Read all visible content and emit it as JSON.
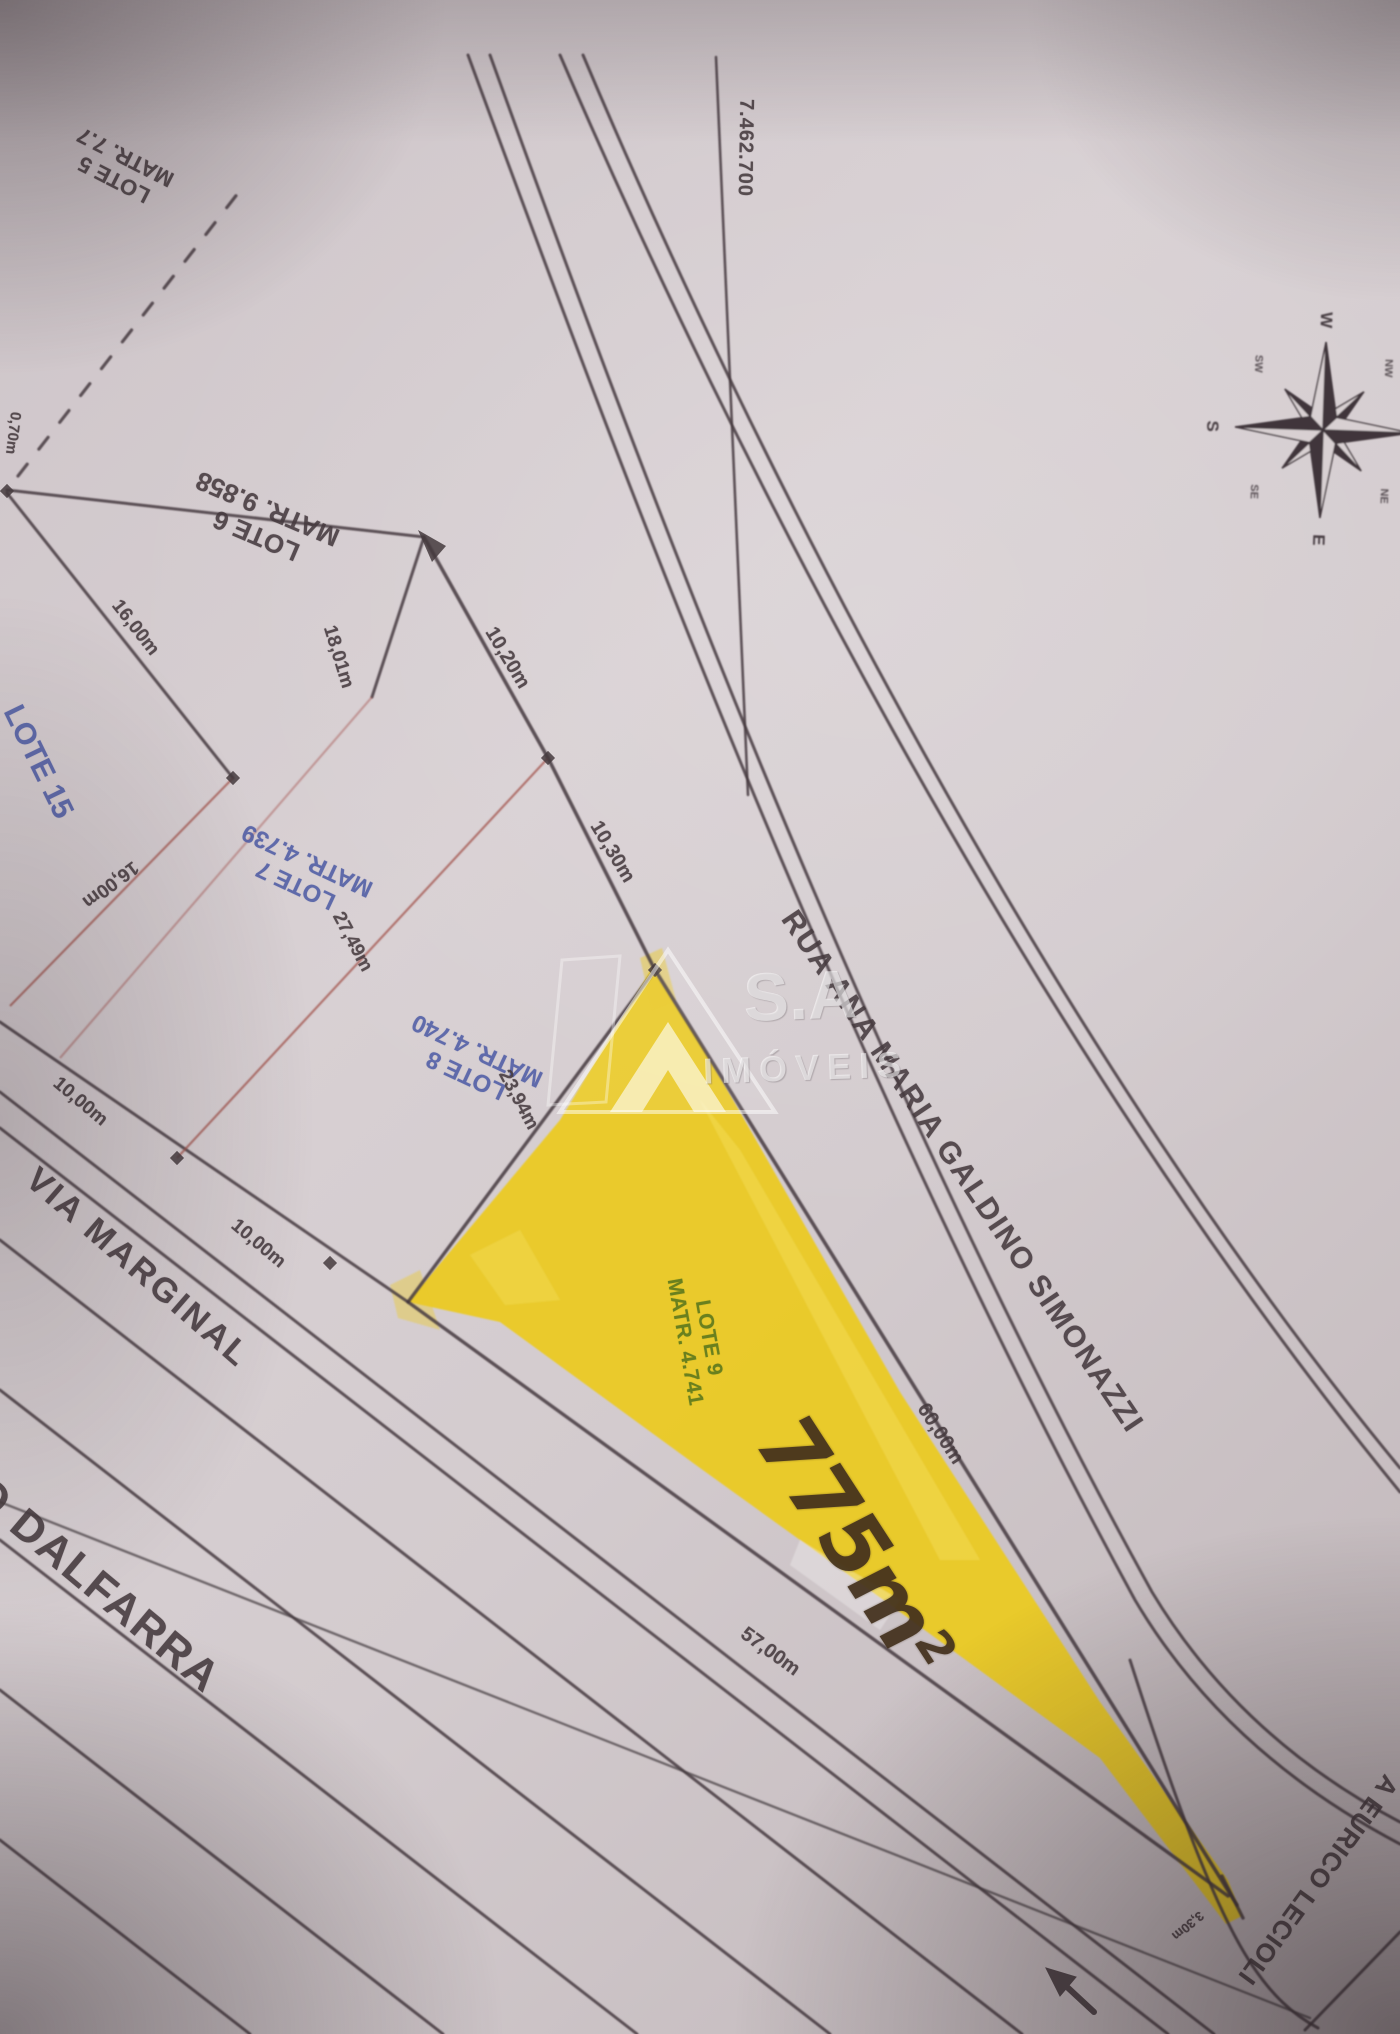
{
  "paper": {
    "coordinate_label": "7.462.700",
    "compass": {
      "n": "N",
      "e": "E",
      "s": "S",
      "w": "W",
      "ne": "NE",
      "nw": "NW",
      "se": "SE",
      "sw": "SW"
    },
    "watermark": {
      "brand": "S.A",
      "word": "IMÓVEIS"
    },
    "streets": {
      "rua_ana": "RUA ANA MARIA GALDINO SIMONAZZI",
      "via_marginal": "VIA MARGINAL",
      "dalfarra": "O DALFARRA",
      "eurico": "A EURICO LECIOLI"
    },
    "lots": {
      "lote5": {
        "label": "LOTE 5",
        "matricula": "MATR. 7.7"
      },
      "lote6": {
        "label": "LOTE 6",
        "matricula": "MATR. 9.858"
      },
      "lote7": {
        "label": "LOTE 7",
        "matricula": "MATR. 4.739"
      },
      "lote8": {
        "label": "LOTE 8",
        "matricula": "MATR. 4.740"
      },
      "lote9": {
        "label": "LOTE 9",
        "matricula": "MATR. 4.741",
        "area": "775m",
        "area_exp": "2"
      },
      "lote15": {
        "label": "LOTE 15"
      }
    },
    "dims": {
      "d070": "0,70m",
      "d1600a": "16,00m",
      "d1801": "18,01m",
      "d1020": "10,20m",
      "d1030": "10,30m",
      "d1600b": "16,00m",
      "d2749": "27,49m",
      "d2394": "23,94m",
      "d1000a": "10,00m",
      "d1000b": "10,00m",
      "d6000": "60,00m",
      "d5700": "57,00m",
      "d330": "3,30m"
    },
    "colors": {
      "highlight": "#ecca21",
      "blue_text": "#4f5da5",
      "green_text": "#647d1e",
      "red_line": "#a3544d",
      "ink": "#453a3e"
    }
  }
}
